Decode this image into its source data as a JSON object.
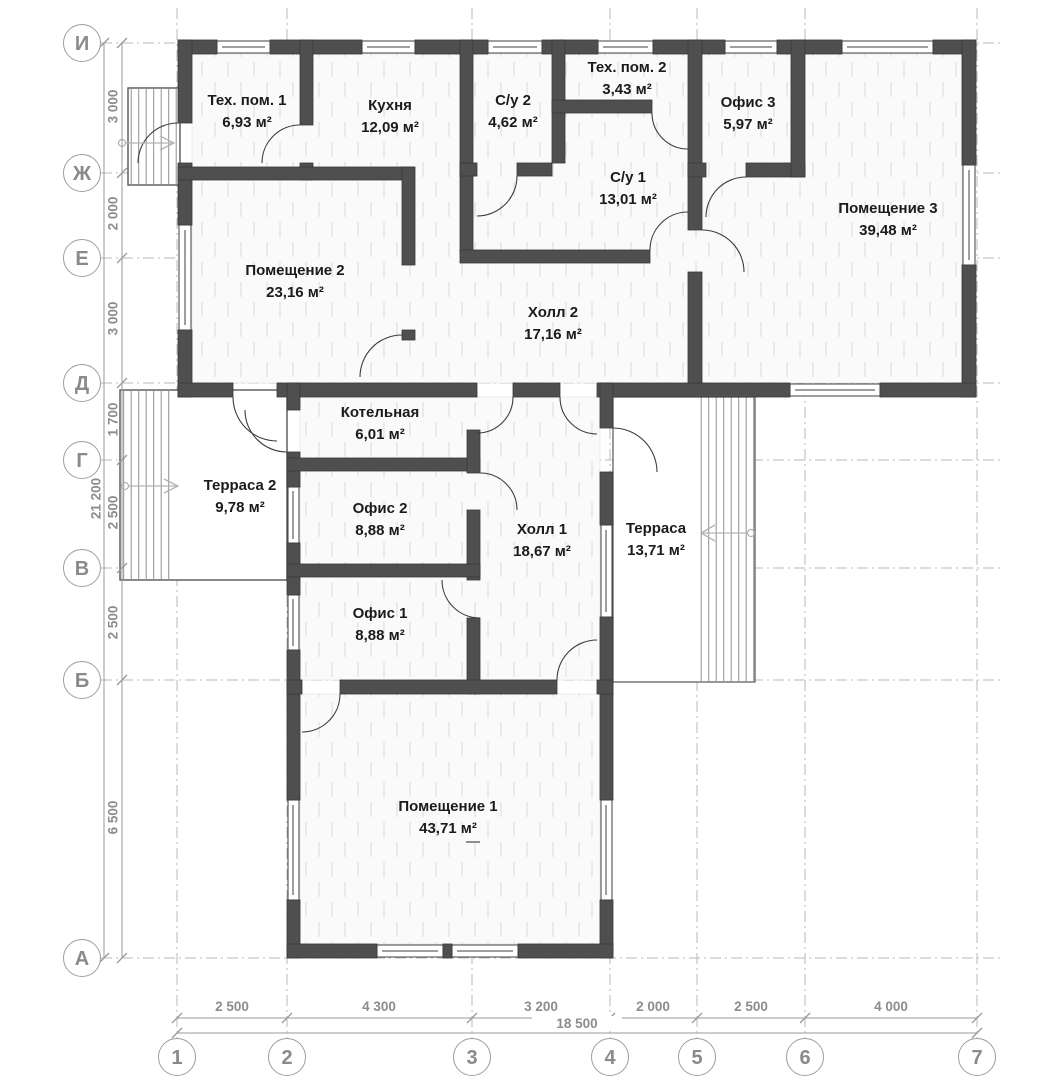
{
  "rooms": [
    {
      "name": "Тех. пом. 1",
      "area": "6,93 м²"
    },
    {
      "name": "Кухня",
      "area": "12,09 м²"
    },
    {
      "name": "С/у 2",
      "area": "4,62 м²"
    },
    {
      "name": "Тех. пом. 2",
      "area": "3,43 м²"
    },
    {
      "name": "Офис 3",
      "area": "5,97 м²"
    },
    {
      "name": "С/у 1",
      "area": "13,01 м²"
    },
    {
      "name": "Помещение 3",
      "area": "39,48 м²"
    },
    {
      "name": "Помещение 2",
      "area": "23,16 м²"
    },
    {
      "name": "Холл 2",
      "area": "17,16 м²"
    },
    {
      "name": "Котельная",
      "area": "6,01 м²"
    },
    {
      "name": "Терраса 2",
      "area": "9,78 м²"
    },
    {
      "name": "Офис 2",
      "area": "8,88 м²"
    },
    {
      "name": "Холл 1",
      "area": "18,67 м²"
    },
    {
      "name": "Терраса",
      "area": "13,71 м²"
    },
    {
      "name": "Офис 1",
      "area": "8,88 м²"
    },
    {
      "name": "Помещение 1",
      "area": "43,71 м²"
    }
  ],
  "axes_left": [
    "И",
    "Ж",
    "Е",
    "Д",
    "Г",
    "В",
    "Б",
    "А"
  ],
  "axes_bottom": [
    "1",
    "2",
    "3",
    "4",
    "5",
    "6",
    "7"
  ],
  "dims_left": [
    "3 000",
    "2 000",
    "3 000",
    "1 700",
    "2 500",
    "2 500",
    "6 500"
  ],
  "dims_left_total": "21 200",
  "dims_bottom": [
    "2 500",
    "4 300",
    "3 200",
    "2 000",
    "2 500",
    "4 000"
  ],
  "dims_bottom_total": "18 500",
  "colors": {
    "wall": "#4f4f4f",
    "grid": "#b8b8b8",
    "dim": "#9a9a9a",
    "text": "#1b1b1b"
  }
}
